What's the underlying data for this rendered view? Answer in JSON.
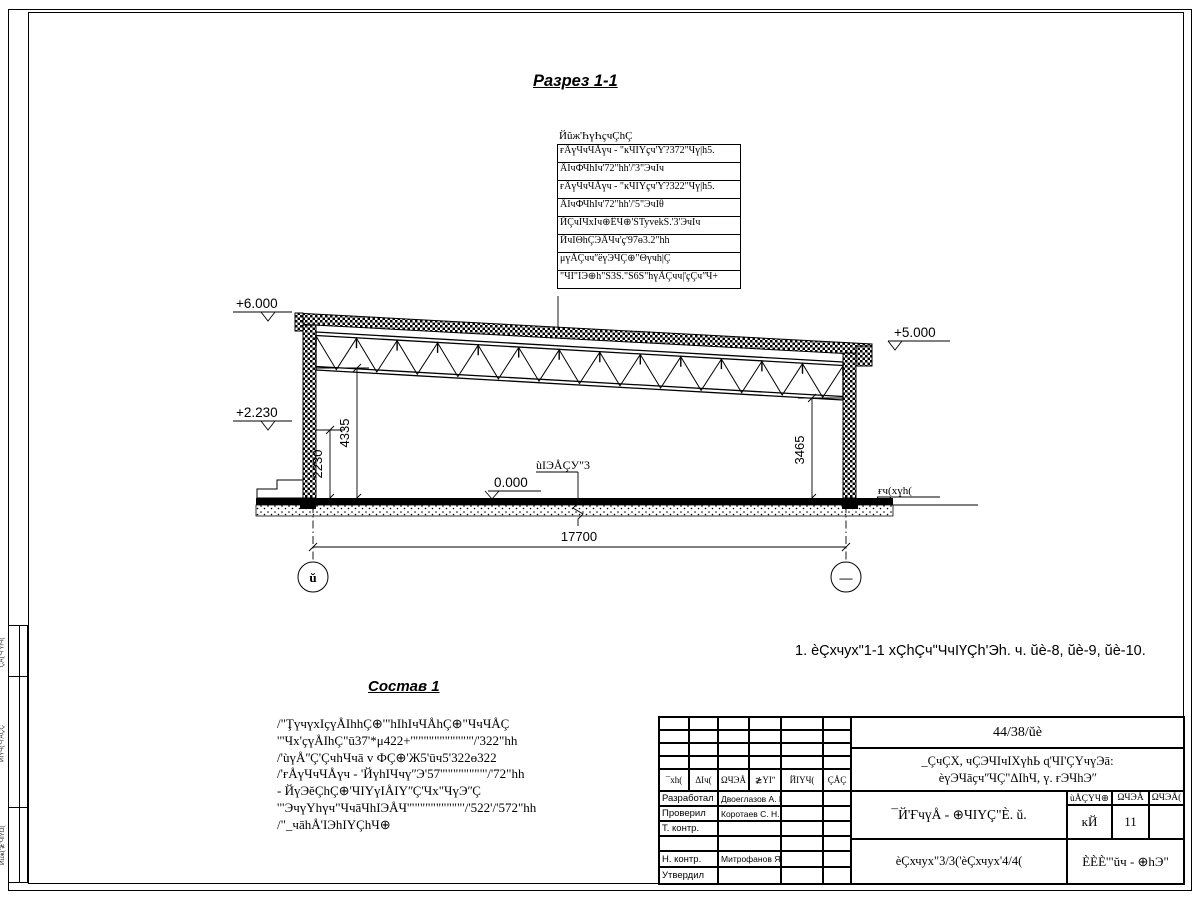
{
  "section": {
    "title": "Разрез 1-1",
    "callout": {
      "header": "Йũж'ҺүҺҫчÇhÇ",
      "rows": [
        "ғÅүЧчЧÅүч - \"ĸЧIҮҫч'Ƴ?372\"Чү|h5.",
        "ÅIчФЧhIч'72\"hh'/'3\"ЭчIч",
        "ғÅүЧчЧÅүч - \"ĸЧIҮҫч'Ƴ?322\"Чү|h5.",
        "ÅIчФЧhIч'72\"hh'/'5\"ЭчIθ",
        "ЙÇчIЧхIч⊕ÊЧ⊕'ṠTyvekṠ.'3'ЭчIч",
        "ЙчIΘhÇЭÅЧч'ҫ'97ө3.2\"hh",
        "μүÅÇччʺёүЭЧÇ⊕\"Θүчh|Ç",
        "\"ЧI\"IЭ⊕h\"Ṡ3Ṡ.\"Ṡ6Ṡ\"hүÅÇчч|'ҫÇчʺЧ+"
      ]
    },
    "elevations": {
      "roof_left": "+6.000",
      "mid_left": "+2.230",
      "roof_right": "+5.000",
      "floor": "0.000",
      "ground_right": "ғч(хүh(",
      "floor_label": "ùIЭÅÇУ\"3"
    },
    "dimensions": {
      "left_inner": "2230",
      "left_full": "4335",
      "right_full": "3465",
      "span": "17700"
    },
    "axes": {
      "left": "ŭ",
      "right": "—"
    }
  },
  "note": "1. èÇхчух\"1-1 хÇhÇчʺЧчIҮÇh'Эh. ч. ŭè-8, ŭè-9, ŭè-10.",
  "sostav": {
    "title": "Состав 1",
    "lines": [
      "/\"ŢүчүхIҫүÅIhhÇ⊕'\"hIhIчЧÅhÇ⊕\"ЧчЧÅÇ",
      "'\"Чх'ҫүÅIhÇ\"ū37'*μ422+'\"\"\"\"\"\"\"\"\"\"\"'/'322\"hh",
      "/'ùүÅʺÇ'ÇчhЧчā v ФÇ⊕'Ж5'ūч5'322ө322",
      "/'ғÅүЧчЧÅүч - 'ЙүhIЧчүʺЭ'57'\"\"\"\"\"\"\"\"'/'72\"hh",
      "- ЙүЭĕÇhÇ⊕'ЧIҮүIÅIҮʺÇ'Чх\"ЧүЭʺÇ",
      "'\"ЭчүҮhүч\"ЧчāЧhIЭÅЧ'\"\"\"\"\"\"\"\"\"\"'/'522'/'572\"hh",
      "/\"_чāhÅ'IЭhIҮÇhЧ⊕"
    ]
  },
  "titleblock": {
    "code": "44/38/ŭè",
    "project_line1": "_ÇчÇХ, чÇЭЧIчIХүhЬ ɋ'ЧI'ÇҮчүЭā:",
    "project_line2": "èүЭЧāҫчʺЧÇ\"ΔIhЧ, ү. ғЭЧhЭʺ",
    "doc_name": "¯Й'ҒчүÅ - ⊕ЧIҮÇ\"È. ŭ.",
    "sheet_name": "èÇхчух\"3/3('èÇхчух'4/4(",
    "org": "ÈÈÈ'\"ŭч - ⊕hЭ\"",
    "rev_headers": [
      "¯хh(",
      "ΔIч(",
      "ΩЧЭÅ",
      "≵YIʺ",
      "ЙIҮЧ(",
      "ÇÅÇ"
    ],
    "stage_headers": [
      "ùÅÇҮЧ⊕",
      "ΩЧЭÅ",
      "ΩЧЭÅ("
    ],
    "stage_values": [
      "ĸЙ",
      "11",
      ""
    ],
    "sig_rows": [
      {
        "label": "Разработал",
        "name": "Двоеглазов А. В."
      },
      {
        "label": "Проверил",
        "name": "Коротаев С. Н."
      },
      {
        "label": "Т. контр.",
        "name": ""
      },
      {
        "label": "",
        "name": ""
      },
      {
        "label": "Н. контр.",
        "name": "Митрофанов Я. А."
      },
      {
        "label": "Утвердил",
        "name": ""
      }
    ]
  },
  "margin_strip": {
    "cells": [
      "¯ÇÅ('Ч'ҮIЧ(",
      "ЙIҮЧ('Ч'ÅÇÇ",
      "Йũж('≵'ЧIҮΩ("
    ]
  }
}
